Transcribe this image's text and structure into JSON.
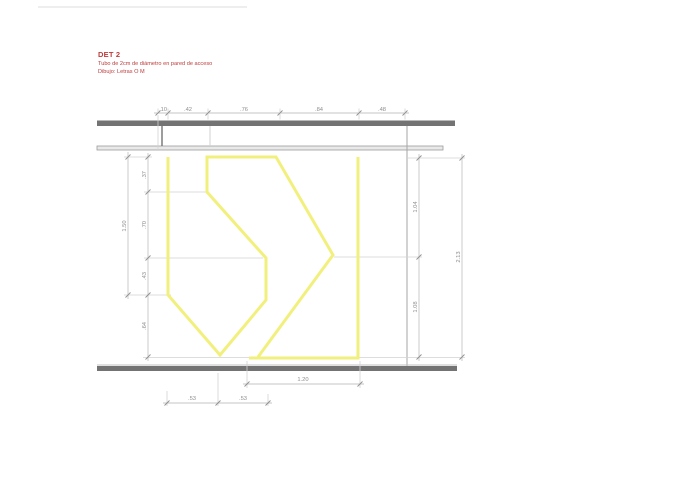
{
  "title_block": {
    "title": "DET 2",
    "subtitle1": "Tubo de 2cm de diámetro en pared de acceso",
    "subtitle2": "Dibujo: Letras O M"
  },
  "colors": {
    "tube_yellow": "#f2f07d",
    "wall_gray": "#737373",
    "dim_gray": "#8f8f8f",
    "title_red": "#bd3b3b"
  },
  "dims": {
    "top": [
      ".10",
      ".42",
      ".76",
      ".84",
      ".48"
    ],
    "left_total": "1.50",
    "left": [
      ".37",
      ".70",
      ".43",
      ".64"
    ],
    "right": [
      "1.04",
      "1.08"
    ],
    "right_total": "2.13",
    "bottom_total": "1.20",
    "bottom": [
      ".53",
      ".53"
    ]
  },
  "tube": {
    "color": "#f2f07d",
    "width": 3,
    "polylines": [
      [
        [
          168,
          157
        ],
        [
          168,
          295
        ],
        [
          220,
          355
        ],
        [
          266,
          300
        ],
        [
          266,
          258
        ],
        [
          207,
          192
        ],
        [
          207,
          157
        ],
        [
          276,
          157
        ],
        [
          333,
          255
        ],
        [
          258,
          357
        ]
      ],
      [
        [
          249,
          358
        ],
        [
          358,
          358
        ],
        [
          358,
          157
        ]
      ]
    ]
  }
}
